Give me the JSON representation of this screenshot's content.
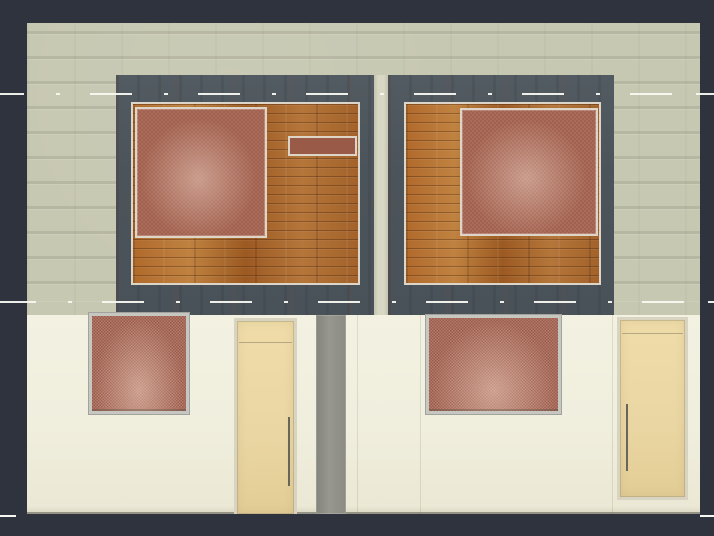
{
  "scene": {
    "type": "cad-elevation-render",
    "description": "Front elevation of a semi-detached duplex facade rendered in a CAD viewport",
    "floors": 2,
    "upper_window_assemblies": 2,
    "lower_windows": 2,
    "doors": 2,
    "centerlines": 3
  },
  "palette": {
    "bg": "#2e333d",
    "upper-wall": "#c7c8b2",
    "lower-wall": "#f0eedd",
    "frame": "#4c545b",
    "gap": "#d7d7c4",
    "panel-border": "#dcd5c8",
    "glass-red": "#a2604e",
    "glass-red-dark": "#9a5a48",
    "wood": "#ad6a2f",
    "door": "#ead6a2",
    "door-frame": "#d8d4c1",
    "low-frame": "#c7c7c1",
    "divider": "#97978f",
    "handle": "#66665a",
    "centerline": "#f8f8f2"
  }
}
